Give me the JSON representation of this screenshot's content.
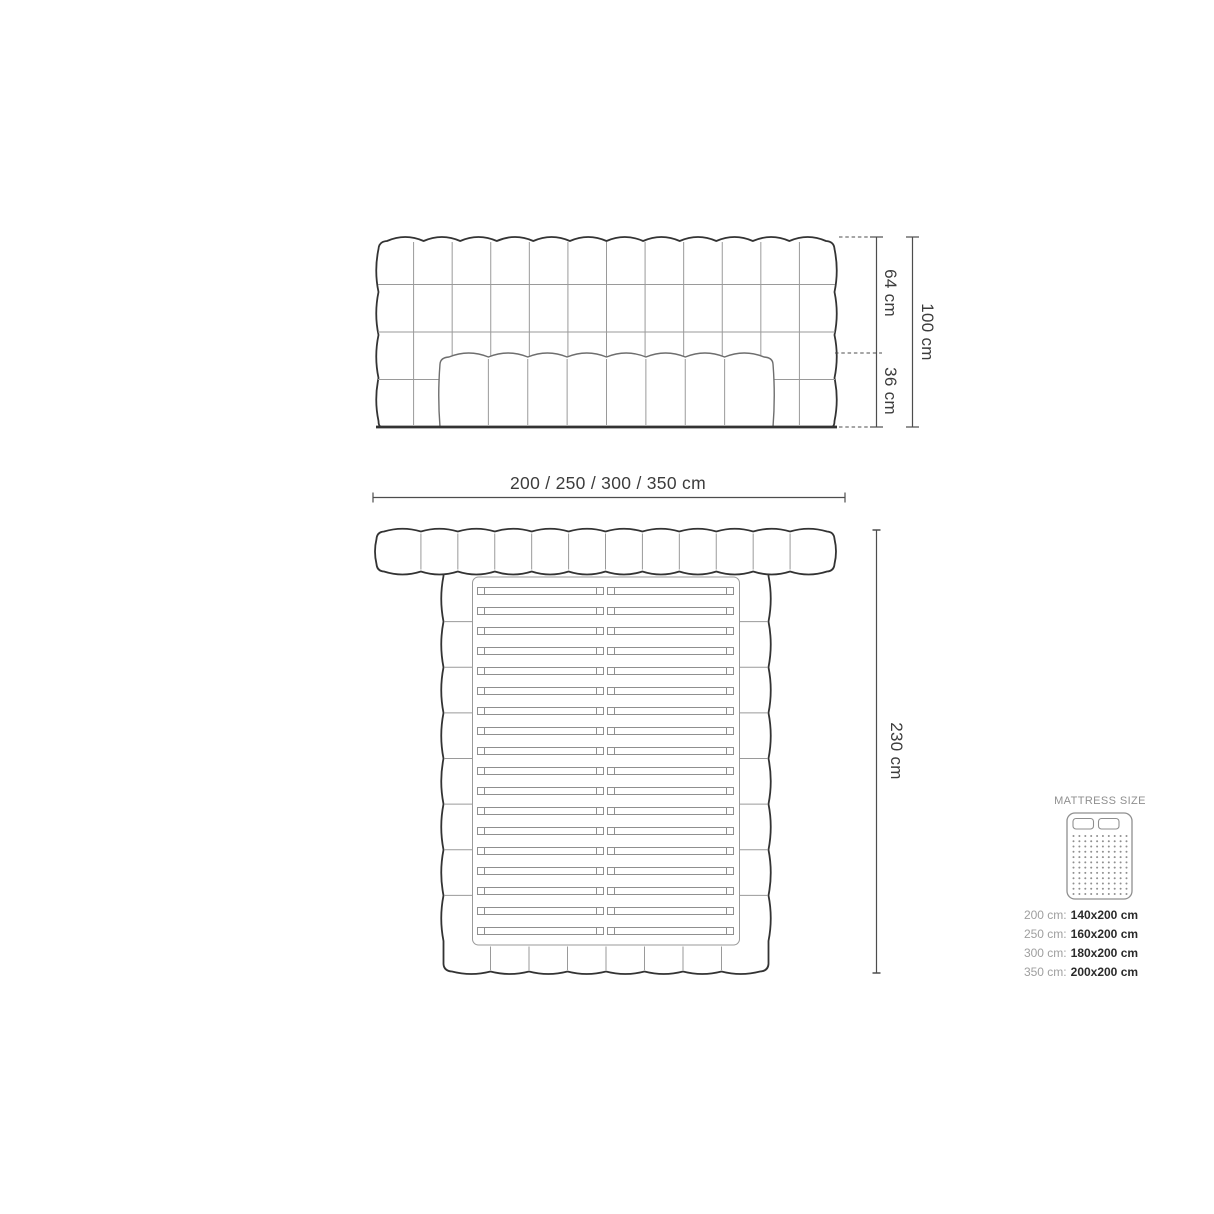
{
  "theme": {
    "background": "#ffffff",
    "outline": "#333333",
    "tuft_line": "#9a9a9a",
    "mattress_outline": "#6e6e6e",
    "slat_line": "#8f8f8f",
    "dimension_line": "#4d4d4d",
    "dimension_text": "#3c3c3c",
    "legend_gray": "#8f8f8f",
    "legend_key": "#9f9f9f",
    "legend_value": "#2b2b2b"
  },
  "dimensions": {
    "width_options": "200 / 250 / 300 / 350 cm",
    "headboard_height": "100 cm",
    "headboard_above_mattress": "64 cm",
    "mattress_height": "36 cm",
    "bed_depth": "230 cm"
  },
  "legend": {
    "title": "MATTRESS SIZE",
    "rows": [
      {
        "width": "200 cm:",
        "size": "140x200 cm"
      },
      {
        "width": "250 cm:",
        "size": "160x200 cm"
      },
      {
        "width": "300 cm:",
        "size": "180x200 cm"
      },
      {
        "width": "350 cm:",
        "size": "200x200 cm"
      }
    ]
  },
  "figure": {
    "front_view": {
      "headboard_columns": 12,
      "headboard_rows": 4,
      "mattress_tufts": 8
    },
    "plan_view": {
      "headboard_columns": 12,
      "side_rail_segments": 8,
      "footboard_segments": 8,
      "slat_rows": 18,
      "slats_per_row": 2
    },
    "mattress_icon": {
      "pillow_count": 2,
      "dot_rows": 12,
      "dot_columns": 10
    }
  }
}
